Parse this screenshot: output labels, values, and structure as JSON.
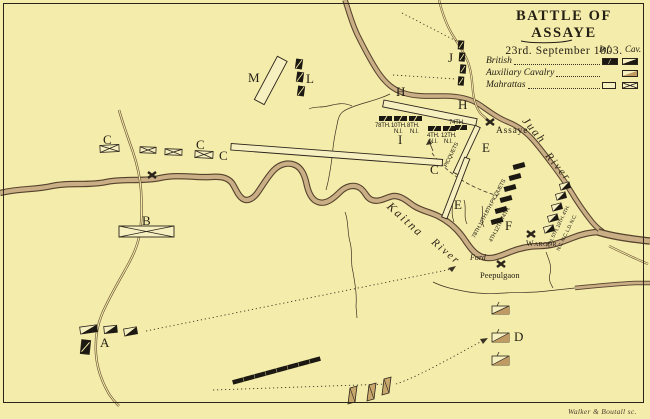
{
  "title": {
    "main": "BATTLE OF ASSAYE",
    "date": "23rd. September 1803."
  },
  "legend": {
    "col_inf": "Inf.",
    "col_cav": "Cav.",
    "rows": [
      {
        "label": "British"
      },
      {
        "label": "Auxiliary Cavalry"
      },
      {
        "label": "Mahrattas"
      }
    ]
  },
  "letters": {
    "a": "A",
    "b": "B",
    "c": "C",
    "d": "D",
    "e": "E",
    "f": "F",
    "h": "H",
    "i": "I",
    "j": "J",
    "l": "L",
    "m": "M"
  },
  "first_line": {
    "r78": "78TH.",
    "r10": "10TH.",
    "r8": "8TH.",
    "ni": "N.I.",
    "r4": "4TH.",
    "r12": "12TH.",
    "r74": "74TH."
  },
  "picquets_label": "PICQUETS",
  "second_position": {
    "left_column": "78TH.10TH.8TH.PICQUETS",
    "right_column": "4TH.12TH.74TH."
  },
  "cavalry_column": {
    "regiments": "7TH. 5TH. 19TH. 4TH.",
    "corps": "N.C. N.C. L.D. N.C."
  },
  "places": {
    "assaye": "Assaye",
    "waroor": "Waroor",
    "ford": "Ford",
    "peepulgaon": "Peepulgaon"
  },
  "rivers": {
    "kaitna_1": "Kaitna",
    "kaitna_2": "River",
    "juah_1": "Juah",
    "juah_2": "River"
  },
  "credit": "Walker & Boutall sc.",
  "colors": {
    "background": "#f4ecaa",
    "ink": "#211c13",
    "river_fill": "#c9ae86",
    "auxiliary_fill": "#bf9a62"
  }
}
